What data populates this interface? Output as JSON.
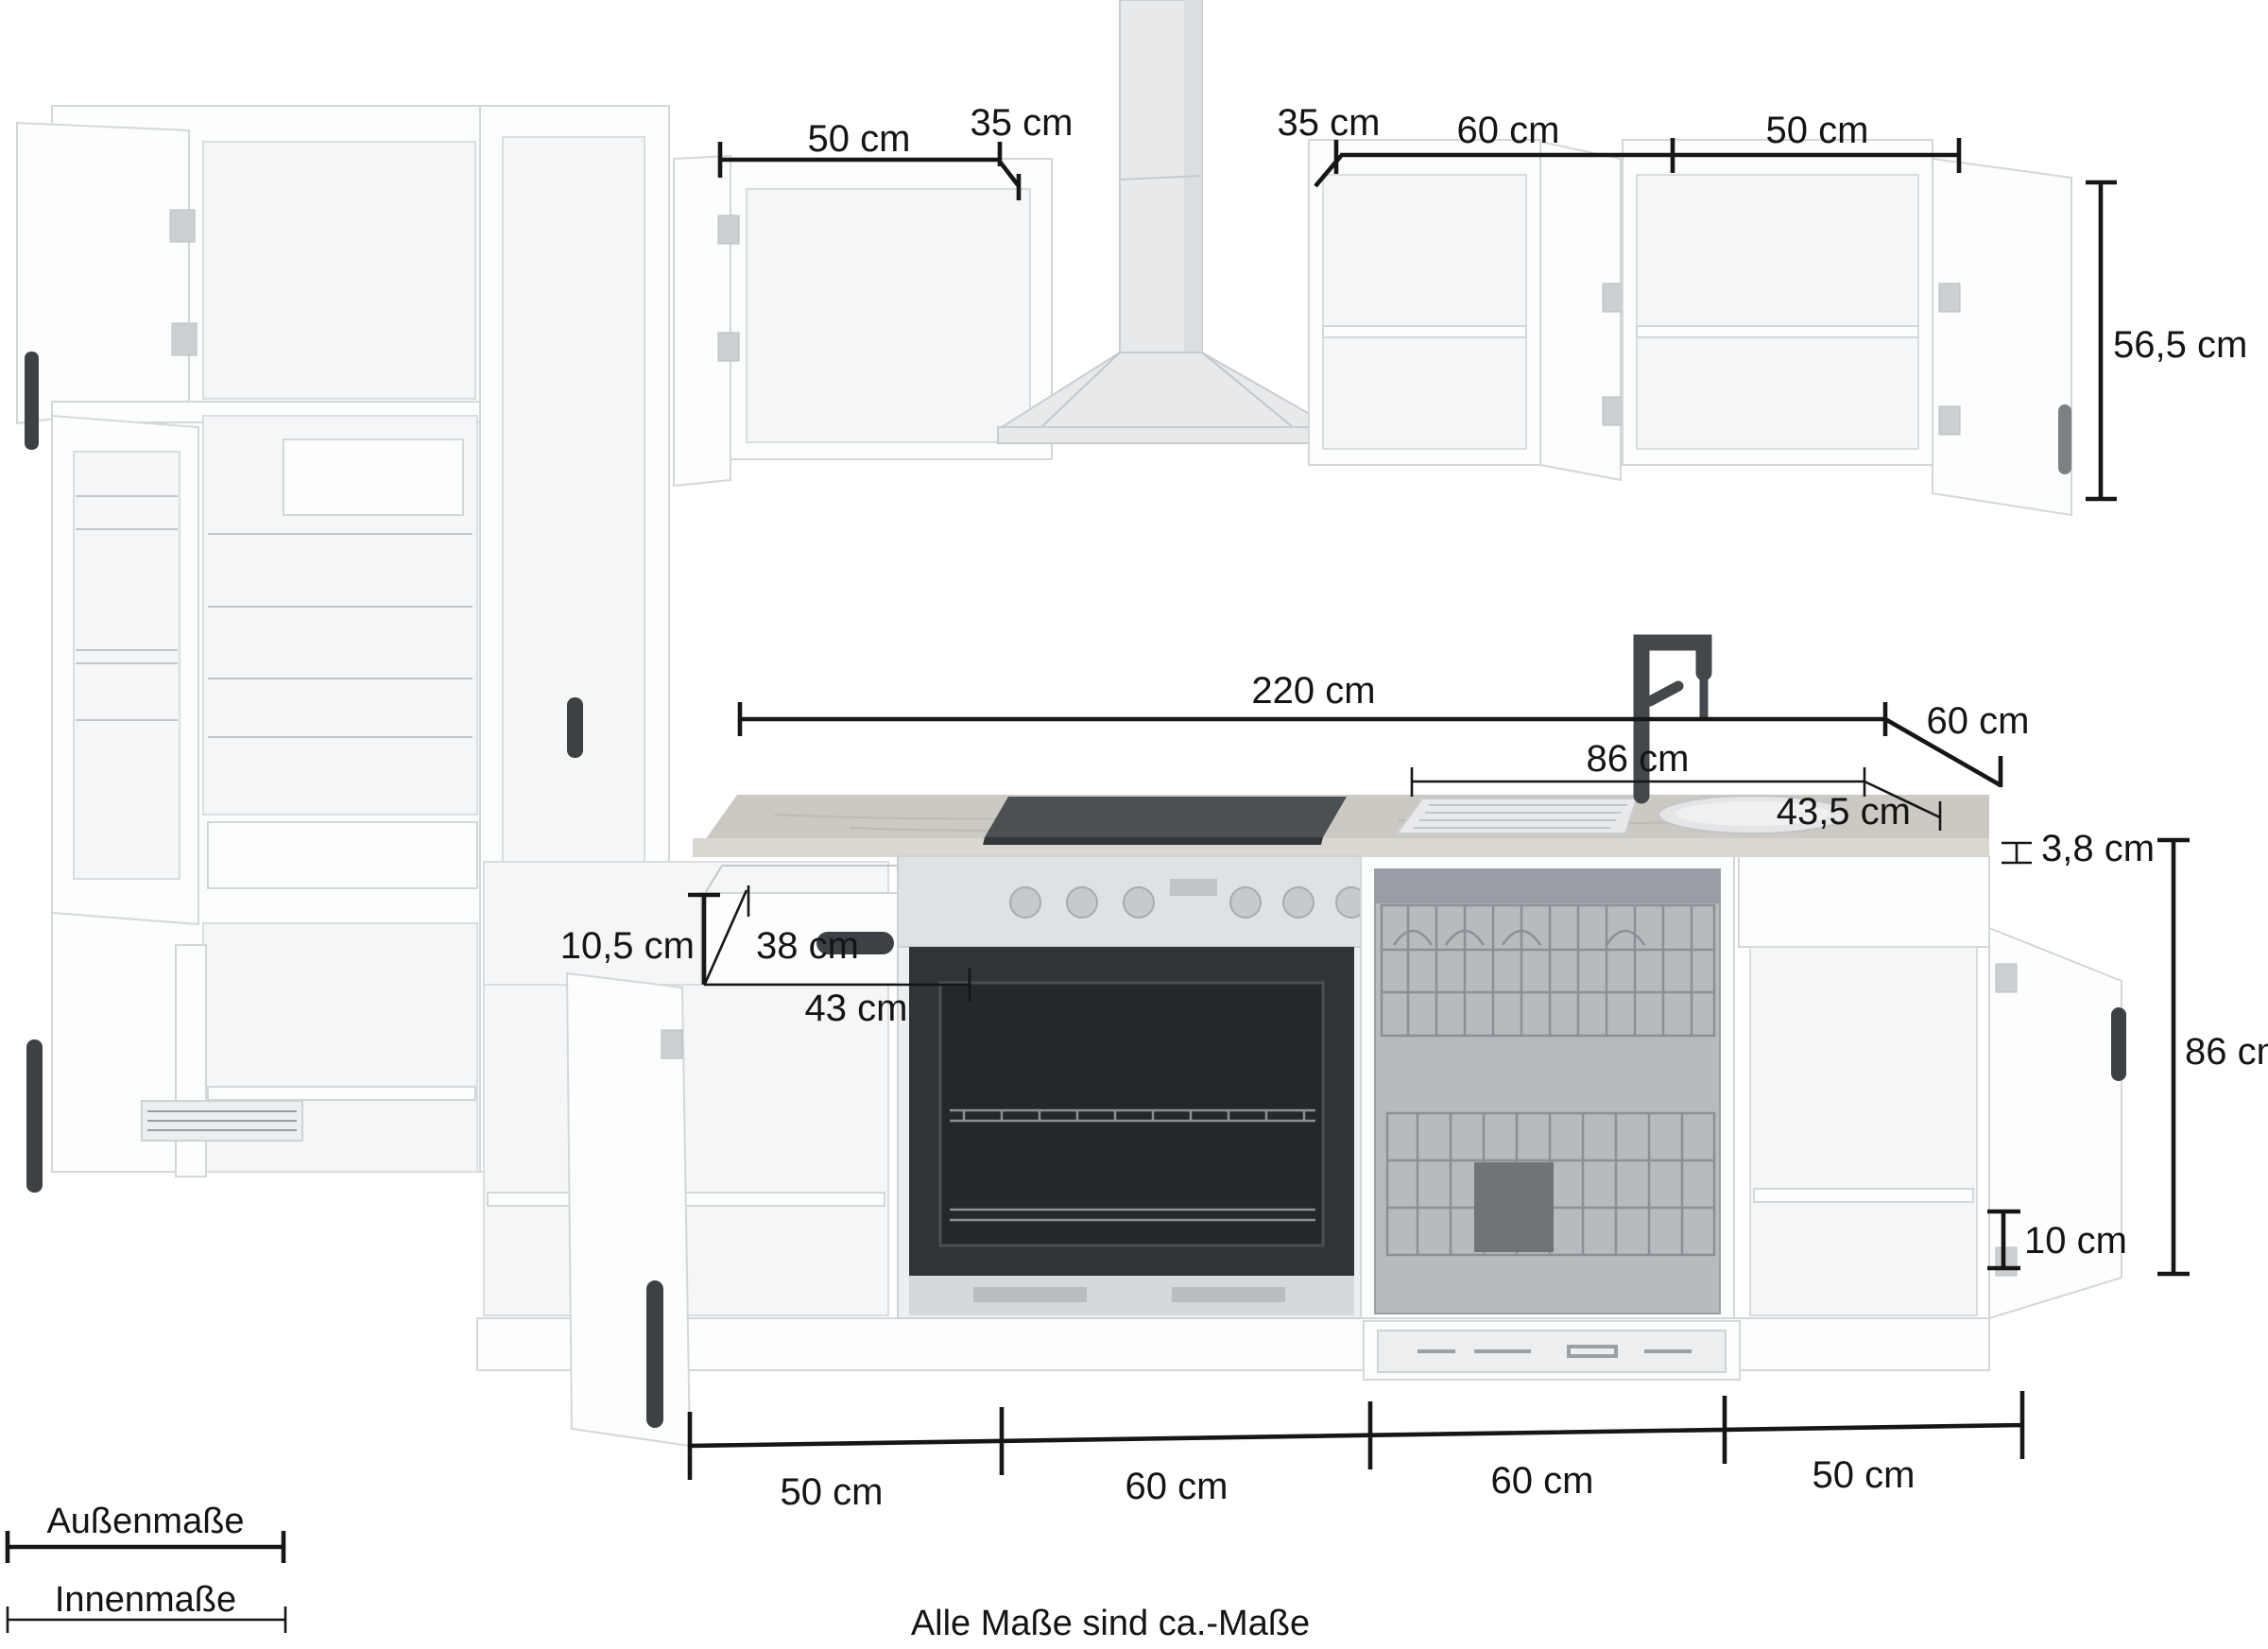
{
  "colors": {
    "background": "#ffffff",
    "dimension_line": "#161616"
  },
  "dimensions": {
    "wall_top_left": {
      "width": "50 cm",
      "depth": "35 cm"
    },
    "wall_top_right": {
      "depth": "35 cm",
      "width_1": "60 cm",
      "width_2": "50 cm"
    },
    "wall_cabinet_height": "56,5 cm",
    "worktop": {
      "total_width": "220 cm",
      "depth": "60 cm",
      "thickness": "3,8 cm"
    },
    "sink": {
      "width": "86 cm",
      "depth": "43,5 cm"
    },
    "drawer": {
      "front_height": "10,5 cm",
      "depth": "38 cm",
      "width": "43 cm"
    },
    "base": {
      "height": "86 cm",
      "plinth_height": "10 cm",
      "widths": [
        "50 cm",
        "60 cm",
        "60 cm",
        "50 cm"
      ]
    }
  },
  "legend": {
    "outer": "Außenmaße",
    "inner": "Innenmaße"
  },
  "footer": {
    "note": "Alle Maße sind ca.-Maße"
  }
}
